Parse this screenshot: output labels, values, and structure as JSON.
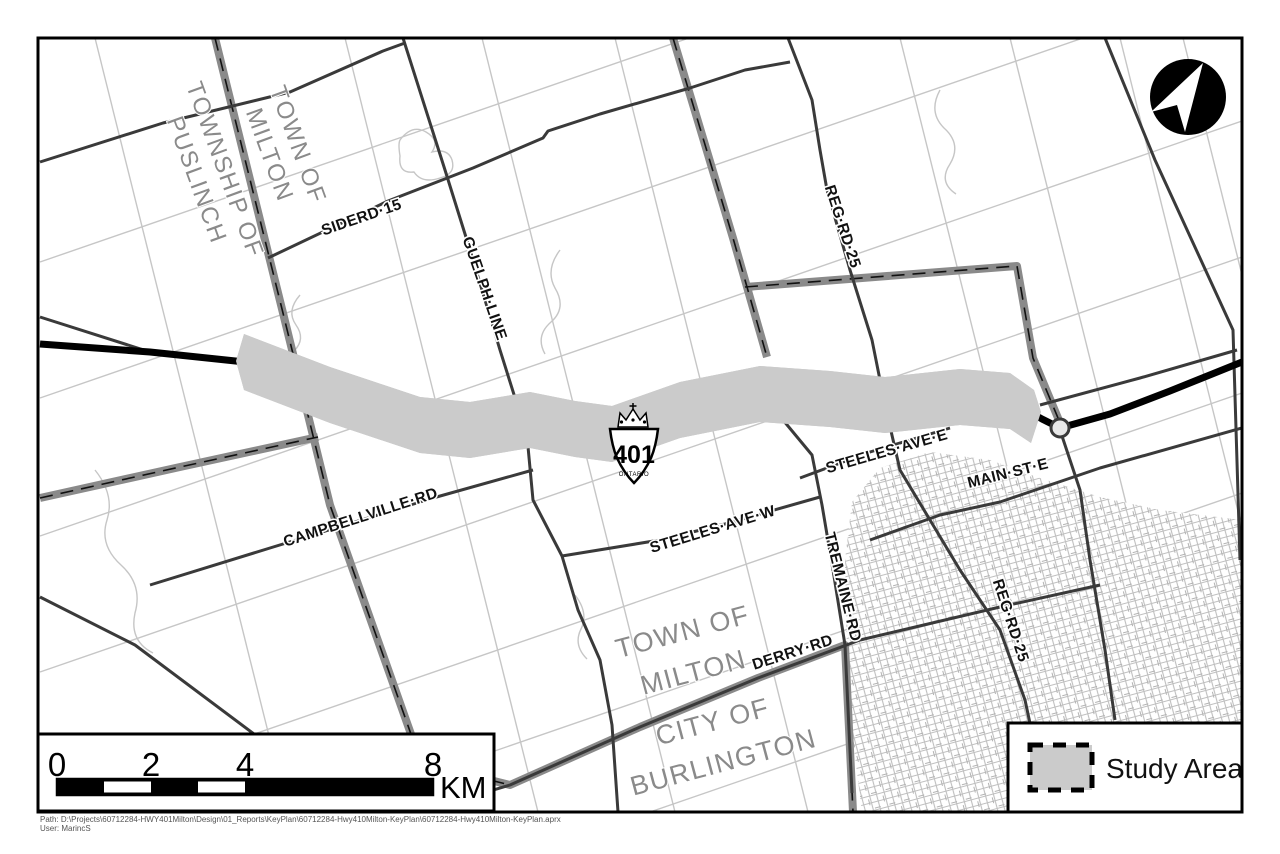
{
  "map": {
    "area_labels": [
      {
        "id": "township-of-puslinch",
        "lines": [
          "TOWNSHIP OF",
          "PUSLINCH"
        ]
      },
      {
        "id": "town-of-milton-nw",
        "lines": [
          "TOWN OF",
          "MILTON"
        ]
      },
      {
        "id": "town-of-milton-s",
        "lines": [
          "TOWN OF",
          "MILTON"
        ]
      },
      {
        "id": "city-of-burlington",
        "lines": [
          "CITY OF",
          "BURLINGTON"
        ]
      }
    ],
    "road_labels": [
      {
        "id": "siderd-15",
        "text": "SIDERD·15"
      },
      {
        "id": "guelph-line",
        "text": "GUELPH·LINE"
      },
      {
        "id": "reg-rd-25-north",
        "text": "REG·RD·25"
      },
      {
        "id": "campbellville-rd",
        "text": "CAMPBELLVILLE·RD"
      },
      {
        "id": "steeles-ave-w",
        "text": "STEELES·AVE·W"
      },
      {
        "id": "steeles-ave-e",
        "text": "STEELES·AVE·E"
      },
      {
        "id": "main-st-e",
        "text": "MAIN·ST·E"
      },
      {
        "id": "tremaine-rd",
        "text": "TREMAINE·RD"
      },
      {
        "id": "derry-rd",
        "text": "DERRY·RD"
      },
      {
        "id": "reg-rd-25-south",
        "text": "REG·RD·25"
      }
    ],
    "highway_shield": {
      "number": "401",
      "province": "ONTARIO"
    }
  },
  "scale_bar": {
    "ticks": [
      "0",
      "2",
      "4",
      "8"
    ],
    "unit": "KM"
  },
  "legend": {
    "items": [
      {
        "label": "Study Area",
        "swatch_fill": "#cbcbcb"
      }
    ]
  },
  "colors": {
    "study_area_fill": "#cbcbcb",
    "boundary_gray": "#8a8a8a",
    "road_dark": "#3a3a3a",
    "road_light": "#c6c6c6",
    "highway": "#000000"
  },
  "footer": {
    "path_line": "Path: D:\\Projects\\60712284-HWY401Milton\\Design\\01_Reports\\KeyPlan\\60712284-Hwy410Milton-KeyPlan\\60712284-Hwy410Milton-KeyPlan.aprx",
    "user_line": "User: MarincS"
  }
}
